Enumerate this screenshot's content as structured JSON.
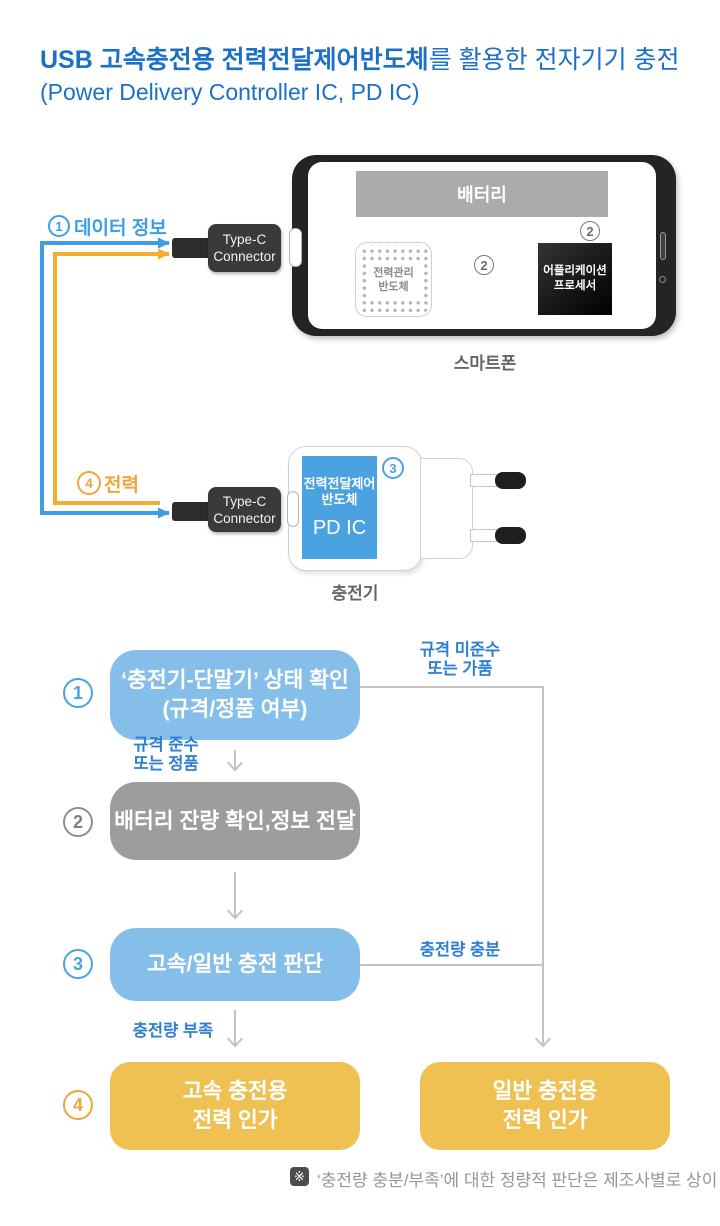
{
  "title": {
    "line1_strong": "USB 고속충전용 전력전달제어반도체",
    "line1_rest": "를 활용한 전자기기 충전",
    "line2": "(Power Delivery Controller IC, PD IC)"
  },
  "diagram": {
    "data_flow": {
      "num": "1",
      "label": "데이터 정보"
    },
    "power_flow": {
      "num": "4",
      "label": "전력"
    },
    "typec_top": {
      "line1": "Type-C",
      "line2": "Connector"
    },
    "typec_bottom": {
      "line1": "Type-C",
      "line2": "Connector"
    },
    "phone": {
      "battery": "배터리",
      "pmic": {
        "line1": "전력관리",
        "line2": "반도체"
      },
      "ap": {
        "line1": "어플리케이션",
        "line2": "프로세서"
      },
      "link_num_ap": "2",
      "link_num_battery": "2",
      "caption": "스마트폰"
    },
    "charger": {
      "pdic": {
        "line1": "전력전달제어",
        "line2": "반도체",
        "line3": "PD IC"
      },
      "num": "3",
      "caption": "충전기"
    }
  },
  "flowchart": {
    "step1": {
      "num": "1",
      "line1": "‘충전기-단말기’ 상태 확인",
      "line2": "(규격/정품 여부)"
    },
    "step2": {
      "num": "2",
      "label": "배터리 잔량 확인,정보 전달"
    },
    "step3": {
      "num": "3",
      "label": "고속/일반 충전 판단"
    },
    "step4": {
      "num": "4",
      "fast": {
        "line1": "고속 충전용",
        "line2": "전력 인가"
      },
      "normal": {
        "line1": "일반 충전용",
        "line2": "전력 인가"
      }
    },
    "labels": {
      "noncompliant": {
        "line1": "규격 미준수",
        "line2": "또는 가품"
      },
      "compliant": {
        "line1": "규격 준수",
        "line2": "또는 정품"
      },
      "charge_enough": "충전량 충분",
      "charge_low": "충전량 부족"
    },
    "footnote": {
      "mark": "※",
      "text": "‘충전량 충분/부족’에 대한 정량적 판단은 제조사별로 상이"
    }
  },
  "colors": {
    "title-blue": "#1b70c8",
    "label-blue": "#2e7fd0",
    "arrow-blue": "#3d9fe3",
    "arrow-orange": "#f2ae33",
    "accent-orange": "#f0a43c",
    "box-blue": "#85bee9",
    "box-gray": "#9d9d9d",
    "box-yellow": "#efc152",
    "pdic-blue": "#4aa3e0",
    "line-gray": "#c3c3c3",
    "battery-gray": "#ababab"
  }
}
